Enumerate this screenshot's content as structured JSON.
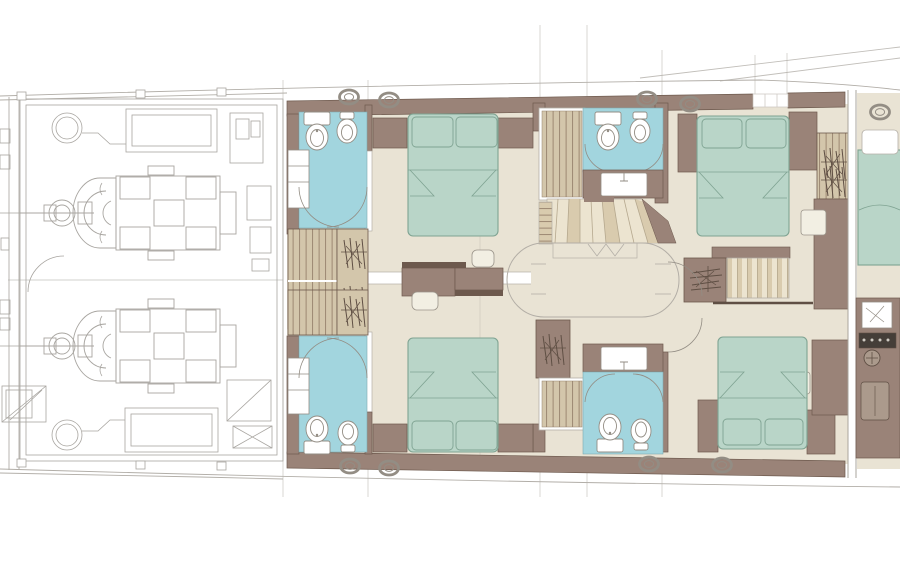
{
  "plan": {
    "type": "yacht-lower-deck-floor-plan",
    "rooms": [
      {
        "id": "engine-room",
        "fixtures": [
          "port-engine",
          "starboard-engine",
          "fuel-tank-fore",
          "fuel-tank-aft",
          "round-hatch-fore",
          "round-hatch-aft",
          "access-ladder",
          "equipment-cabinets"
        ]
      },
      {
        "id": "guest-cabin-upper-left",
        "fixtures": [
          "double-bed",
          "pillows",
          "nightstands",
          "wardrobe",
          "hanging-locker",
          "vanity-desk",
          "stool",
          "ensuite-bathroom",
          "toilet",
          "bidet",
          "washbasin-cabinet",
          "door-arcs"
        ]
      },
      {
        "id": "guest-cabin-lower-left",
        "fixtures": [
          "double-bed",
          "pillows",
          "nightstands",
          "wardrobe",
          "hanging-locker",
          "vanity-desk",
          "stool",
          "ensuite-bathroom",
          "toilet",
          "bidet",
          "washbasin-cabinet",
          "door-arcs"
        ]
      },
      {
        "id": "bathroom-upper-center",
        "fixtures": [
          "shower",
          "toilet",
          "bidet",
          "sink-vanity",
          "door-arcs"
        ]
      },
      {
        "id": "bathroom-lower-center",
        "fixtures": [
          "shower",
          "toilet",
          "bidet",
          "sink-vanity",
          "hanging-locker",
          "door-arcs"
        ]
      },
      {
        "id": "central-lobby",
        "fixtures": [
          "winder-staircase",
          "companionway-stair-to-main-deck",
          "oval-ceiling-outline",
          "hanging-locker"
        ]
      },
      {
        "id": "guest-cabin-upper-right",
        "fixtures": [
          "double-bed",
          "pillows",
          "nightstands",
          "hanging-wardrobe",
          "cabinet-column",
          "seat-cube"
        ]
      },
      {
        "id": "guest-cabin-lower-right",
        "fixtures": [
          "double-bed",
          "pillows",
          "nightstands",
          "cabinet-column",
          "seat-cube"
        ]
      },
      {
        "id": "bow-cabin-partial",
        "fixtures": [
          "double-bed-partial",
          "pillow",
          "console-galley-column",
          "appliance-panel",
          "control-knob"
        ]
      }
    ],
    "portholes_top": 5,
    "portholes_bottom": 4
  },
  "palette": {
    "floor": "#e9e3d4",
    "floorLine": "#cfc8b6",
    "wall": "#9a8378",
    "wallLine": "#6d594d",
    "bath": "#a2d5de",
    "bathLine": "#7fa9b0",
    "bed": "#b9d5c8",
    "bedLine": "#7fa392",
    "stripeTan": "#d3c6ab",
    "stripeLine": "#96816c",
    "tread": "#ece4d0",
    "treadAlt": "#d9cbae",
    "treadLine": "#b5a88e",
    "ink": "#a8a5a0",
    "hullLine": "#b2aea8",
    "ring": "#938d84",
    "dark": "#5f4f44",
    "white": "#ffffff",
    "stool": "#f2efe3",
    "applianceDark": "#453e38",
    "consoleTan": "#ab9a8c"
  }
}
